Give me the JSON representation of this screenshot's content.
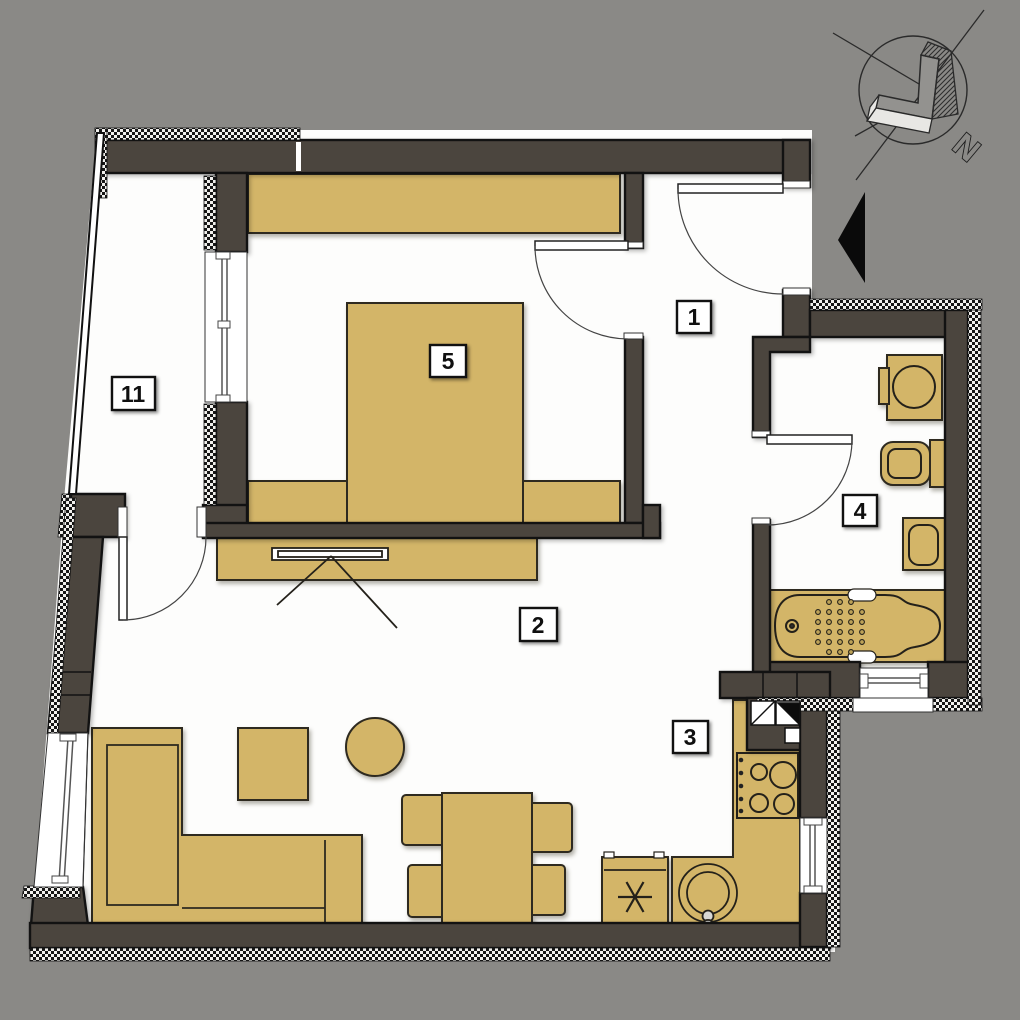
{
  "plan_title": "apartment-floor-plan",
  "colors": {
    "background": "#8a8986",
    "wall_fill": "#4b453e",
    "outline": "#121212",
    "furniture": "#d3b568",
    "floor": "#fdfdfc",
    "label_background": "#ffffff",
    "label_text": "#101010",
    "entrance_arrow": "#0a0a0a"
  },
  "compass": {
    "north_label": "N",
    "icon": "north-arrow-icon"
  },
  "entrance": {
    "icon": "entrance-arrow-icon"
  },
  "rooms": [
    {
      "id": "hallway",
      "number": "1"
    },
    {
      "id": "living-room",
      "number": "2"
    },
    {
      "id": "kitchen",
      "number": "3"
    },
    {
      "id": "bathroom",
      "number": "4"
    },
    {
      "id": "bedroom",
      "number": "5"
    },
    {
      "id": "balcony",
      "number": "11"
    }
  ],
  "furniture_icons": [
    "wardrobe",
    "double-bed",
    "nightstand",
    "tv-cabinet",
    "tv",
    "corner-sofa",
    "side-table",
    "round-table",
    "dining-table",
    "chair",
    "fridge-freezer-snowflake",
    "kitchen-counter",
    "stove-burners",
    "kitchen-sink",
    "vent-shaft",
    "washing-machine",
    "toilet",
    "bathroom-sink",
    "bathtub"
  ]
}
